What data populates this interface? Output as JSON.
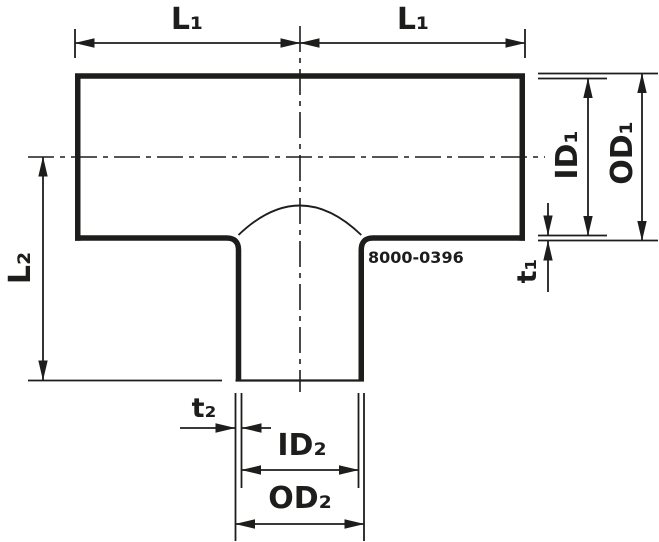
{
  "diagram": {
    "part_number": "8000-0396",
    "dimension_labels": {
      "l1_left": "L₁",
      "l1_right": "L₁",
      "l2": "L₂",
      "id1": "ID₁",
      "od1": "OD₁",
      "t1": "t₁",
      "t2": "t₂",
      "id2": "ID₂",
      "od2": "OD₂"
    },
    "colors": {
      "line": "#1d1d1b",
      "background": "#ffffff"
    }
  }
}
